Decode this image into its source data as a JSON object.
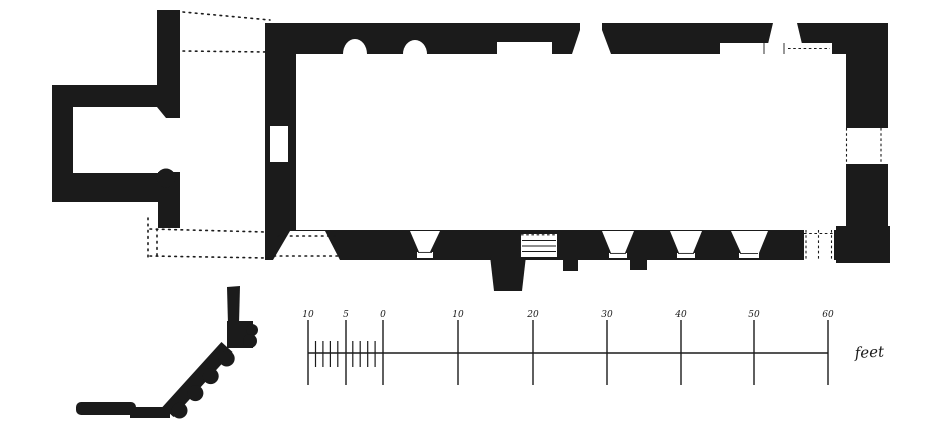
{
  "figure": {
    "description": "Hand-drawn architectural floor plan plate of a small rectangular church with west annexe, with a moulding profile detail at lower left and an imperial scale bar",
    "colors": {
      "ink": "#1b1b1b",
      "paper": "#ffffff"
    }
  },
  "scale_bar": {
    "unit_label": "feet",
    "ticks": [
      {
        "label": "10",
        "x": 308
      },
      {
        "label": "5",
        "x": 346
      },
      {
        "label": "0",
        "x": 383
      },
      {
        "label": "10",
        "x": 458
      },
      {
        "label": "20",
        "x": 533
      },
      {
        "label": "30",
        "x": 607
      },
      {
        "label": "40",
        "x": 681
      },
      {
        "label": "50",
        "x": 754
      },
      {
        "label": "60",
        "x": 828
      }
    ],
    "subdivision_xs": [
      315.5,
      322.9,
      330.4,
      337.8,
      352.8,
      360.2,
      367.7,
      375.1
    ],
    "baseline_y": 353,
    "tick_top": 320,
    "tick_bottom": 385,
    "sub_top": 341,
    "sub_bottom": 367,
    "label_y": 317
  }
}
